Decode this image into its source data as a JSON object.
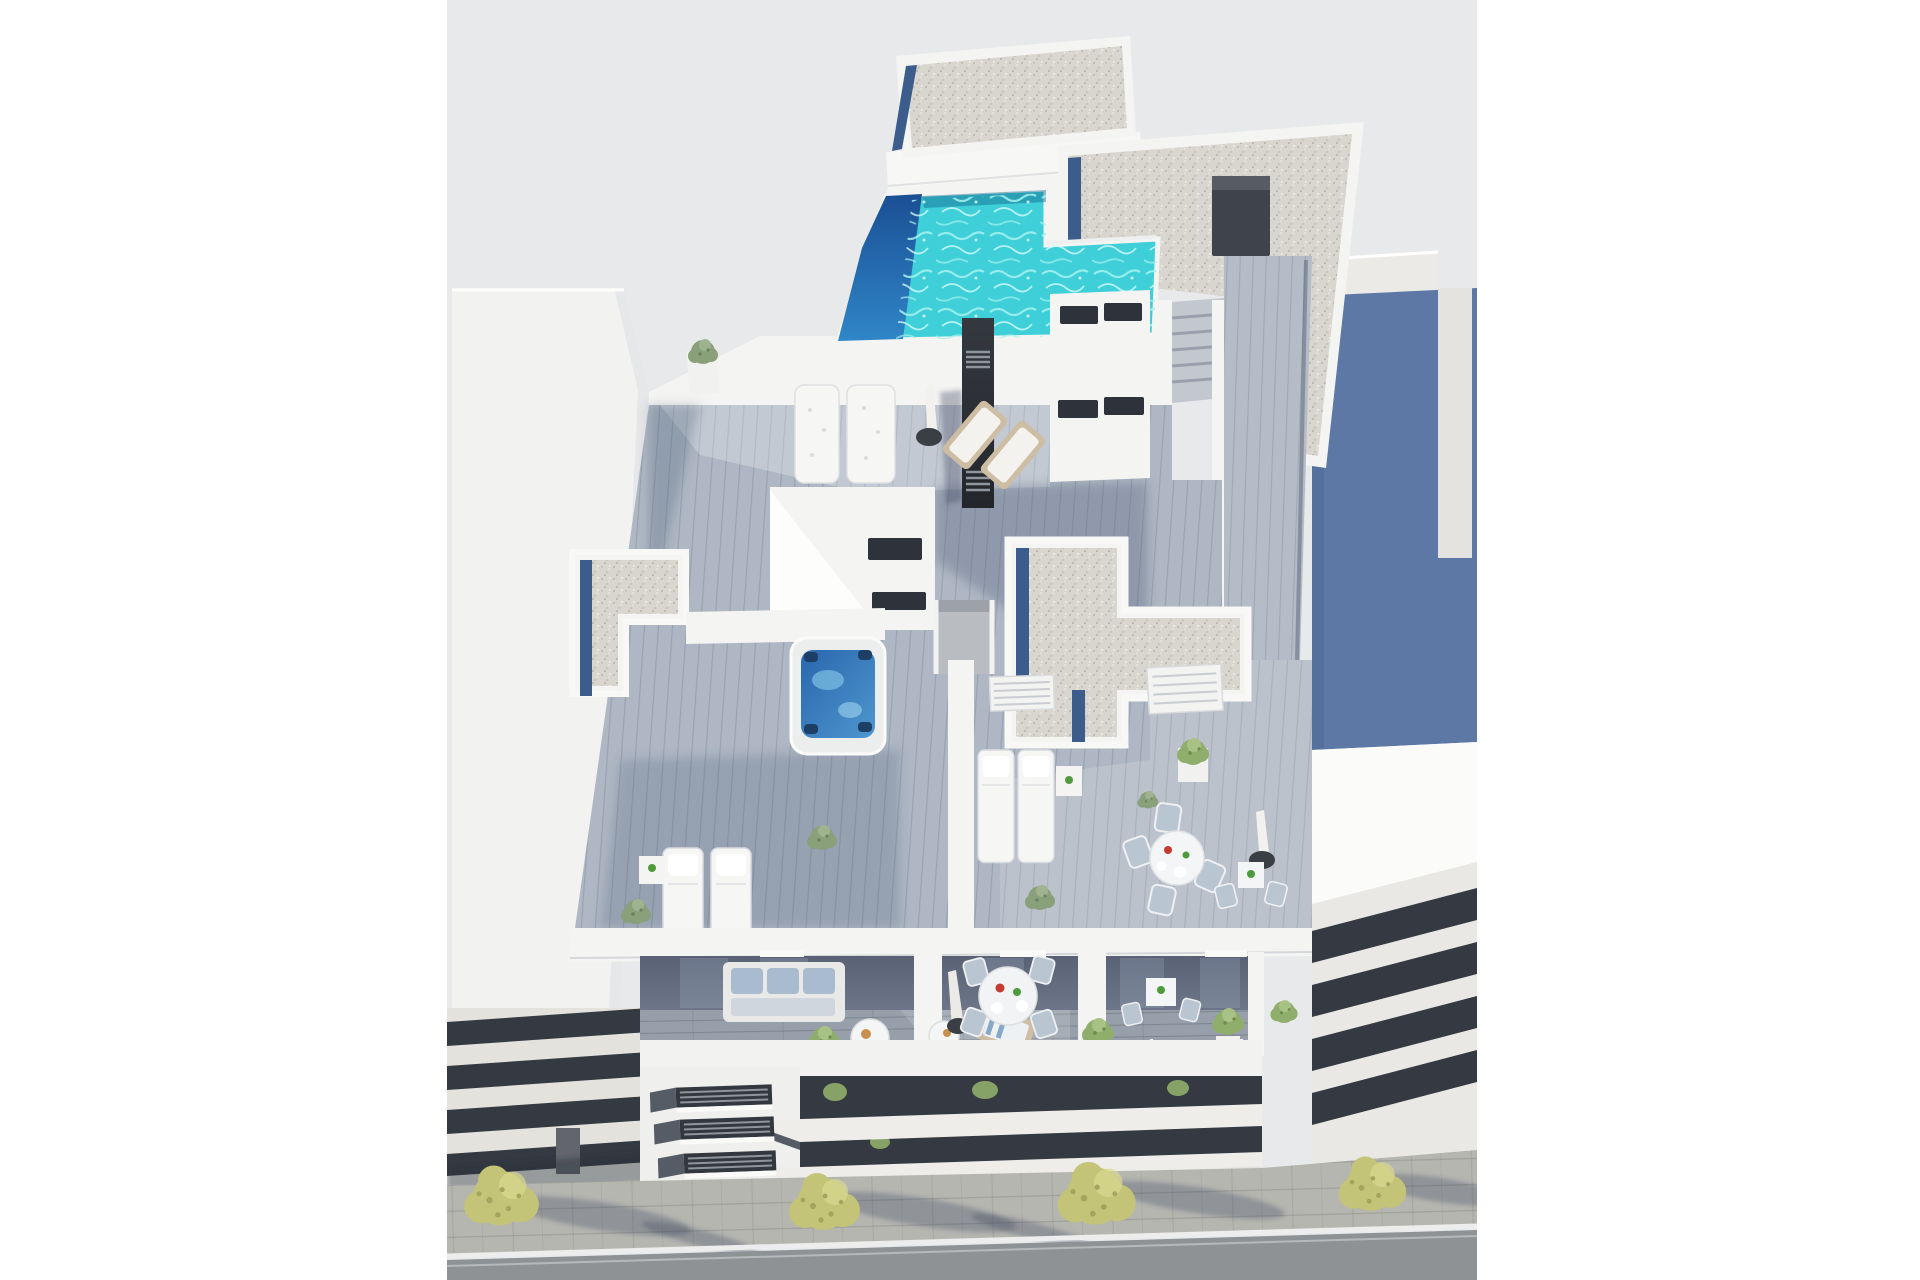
{
  "scene": {
    "type": "architectural-3d-render",
    "view": "aerial-axonometric",
    "subject": "Aerial render of a modern white apartment building rooftop solarium with L-shaped pool, jacuzzi, wood deck terraces, balconies and tree-lined street"
  },
  "objects": {
    "rooftop": [
      "gravel-roof",
      "swimming-pool",
      "pool-heater-monolith",
      "roof-access-stairs",
      "wood-walkway"
    ],
    "deck": [
      "stair-bulkhead",
      "jacuzzi",
      "sun-loungers",
      "daybeds",
      "deck-chairs",
      "parasols",
      "dining-table",
      "bistro-table",
      "planters",
      "louver-panels"
    ],
    "balcony": [
      "sofa-set",
      "coffee-tables",
      "round-dining-set",
      "bistro-set",
      "potted-plants",
      "glass-railing"
    ],
    "street": [
      "sidewalk",
      "trees",
      "road",
      "curb-line"
    ],
    "neighbors": [
      "left-white-building",
      "right-blue-building"
    ]
  },
  "colors": {
    "sky": "#e8e9eb",
    "white": "#f4f4f2",
    "white-bright": "#fbfbfa",
    "wall-shade": "#dcdee1",
    "gravel": "#d9d6cf",
    "blue-strip": "#3c5c8c",
    "pool": "#3ecfd8",
    "pool-deep-top": "#1b4f94",
    "pool-deep-bottom": "#2f86c8",
    "ripple": "#a6f2ef",
    "jacuzzi-rim": "#eceded",
    "jacuzzi-top": "#2a66ad",
    "jacuzzi-bottom": "#4e97cf",
    "wood-mid": "#aeb7c3",
    "wood-shadow": "#97a2b4",
    "corridor-wood": "#b3bcc7",
    "balcony-floor": "#97a0aa",
    "neighbor-blue": "#5d78a4",
    "neighbor-blue-edge": "#54719e",
    "neighbor-roof": "#eceae6",
    "glazing-dark": "#343942",
    "slab-light": "#e3e2dd",
    "interior-top": "#596275",
    "interior-bottom": "#6d7688",
    "monolith-top": "#34383f",
    "monolith-bottom": "#23262b",
    "grill": "#8f959d",
    "furniture-white": "#f6f6f4",
    "cushion-blue": "#a9bccf",
    "chair-gray": "#b9c6d2",
    "wood-furniture": "#cdbda3",
    "tree": "#c3c478",
    "tree-dark": "#a3a55f",
    "tree-light": "#d9d98f",
    "bush": "#8aa07b",
    "bush-bright": "#8fae6b",
    "sidewalk": "#b6b6b1",
    "road": "#8f9294",
    "curb": "#ecedec",
    "parasol-base": "#3a3e45",
    "plate-red": "#c43b2f",
    "plate-green": "#4f9a3c",
    "croissant": "#c98f4e"
  }
}
